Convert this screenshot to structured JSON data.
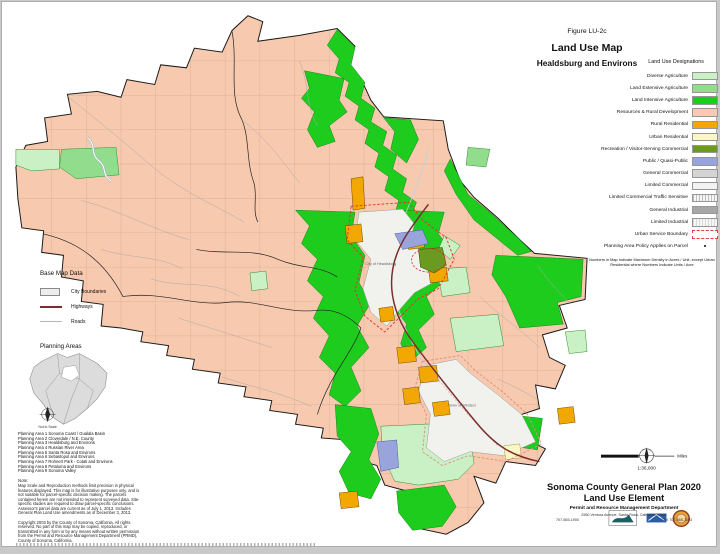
{
  "titles": {
    "figure": "Figure LU-2c",
    "main": "Land Use Map",
    "sub": "Healdsburg and Environs"
  },
  "legend": {
    "header": "Land Use Designations",
    "items": [
      {
        "label": "Diverse Agriculture",
        "color": "#caf0c6",
        "type": "solid"
      },
      {
        "label": "Land Extensive Agriculture",
        "color": "#92dc8e",
        "type": "solid"
      },
      {
        "label": "Land Intensive Agriculture",
        "color": "#1ecc1e",
        "type": "solid"
      },
      {
        "label": "Resources & Rural Development",
        "color": "#f9c9b1",
        "type": "solid"
      },
      {
        "label": "Rural Residential",
        "color": "#f2a800",
        "type": "solid"
      },
      {
        "label": "Urban Residential",
        "color": "#fcf6c4",
        "type": "solid"
      },
      {
        "label": "Recreation / Visitor-Serving Commercial",
        "color": "#6a9a1f",
        "type": "solid"
      },
      {
        "label": "Public / Quasi-Public",
        "color": "#99a3dc",
        "type": "solid"
      },
      {
        "label": "General Commercial",
        "color": "#d4d4d4",
        "type": "solid"
      },
      {
        "label": "Limited Commercial",
        "color": "#f2f2f2",
        "type": "solid"
      },
      {
        "label": "Limited Commercial Traffic Sensitive",
        "color": "#bdbdbd",
        "type": "hatch"
      },
      {
        "label": "General Industrial",
        "color": "#a6a6a6",
        "type": "solid"
      },
      {
        "label": "Limited Industrial",
        "color": "#d9d9d9",
        "type": "hatch"
      },
      {
        "label": "Urban Service Boundary",
        "color": "#e04040",
        "type": "dashed-outline"
      },
      {
        "label": "Planning Area Policy Applies on Parcel",
        "color": "#444444",
        "type": "dot"
      }
    ],
    "note": "Numbers in Map Indicate Maximum Density in Acres / Unit, except Urban Residential where Numbers Indicate Units / Acre"
  },
  "base_map": {
    "header": "Base Map Data",
    "items": [
      {
        "label": "City Boundaries",
        "symbol": "box"
      },
      {
        "label": "Highways",
        "symbol": "thick-line"
      },
      {
        "label": "Roads",
        "symbol": "thin-line"
      }
    ]
  },
  "planning_areas": {
    "header": "Planning Areas",
    "scale_note": "Not to Scale",
    "list": [
      "Planning Area 1 Sonoma Coast / Gualala Basin",
      "Planning Area 2 Cloverdale / N.E. County",
      "Planning Area 3 Healdsburg and Environs",
      "Planning Area 4 Russian River Area",
      "Planning Area 5 Santa Rosa and Environs",
      "Planning Area 6 Sebastopol and Environs",
      "Planning Area 7 Rohnert Park - Cotati and Environs",
      "Planning Area 8 Petaluma and Environs",
      "Planning Area 9 Sonoma Valley"
    ]
  },
  "map": {
    "labels": {
      "healdsburg": "City of Healdsburg",
      "windsor": "Town of Windsor"
    },
    "colors": {
      "land_resources_rural": "#f7c9ae",
      "land_intensive_ag": "#1ecc1e",
      "diverse_ag": "#caf0c6",
      "extensive_ag": "#92dc8e",
      "rural_residential": "#f2a800",
      "public_quasi_public": "#99a3dc",
      "recreation_vsc": "#6a9a1f",
      "urban_residential": "#fcf6c4",
      "city_area": "#f1f1ee",
      "urban_service_boundary": "#e03030",
      "highway": "#7a2e2e"
    }
  },
  "notes": {
    "header": "Note:",
    "body": "Map Scale and Reproduction methods limit precision in physical features displayed. This map is for illustrative purposes only, and is not suitable for parcel-specific decision making. The parcels contained herein are not intended to represent surveyed data. Site-specific studies are required to draw parcel-specific conclusions. Assessor's parcel data are current as of July 1, 2013. Includes General Plan Land Use amendments as of December 3, 2013.",
    "copyright": "Copyright 2003 by the County of Sonoma, California. All rights reserved. No part of this map may be copied, reproduced, or transmitted in any form or by any means without written permission from the Permit and Resource Management Department (PRMD), County of Sonoma, California."
  },
  "scale": {
    "ratio": "1:36,000",
    "units": "Miles"
  },
  "credits": {
    "title": "Sonoma County General Plan 2020",
    "subtitle": "Land Use Element",
    "department": "Permit and Resource Management Department",
    "address": "2550 Ventura Avenue, Santa Rosa, California 95403",
    "phone": "707-565-1900",
    "fax": "FAX 707-565-1103"
  }
}
